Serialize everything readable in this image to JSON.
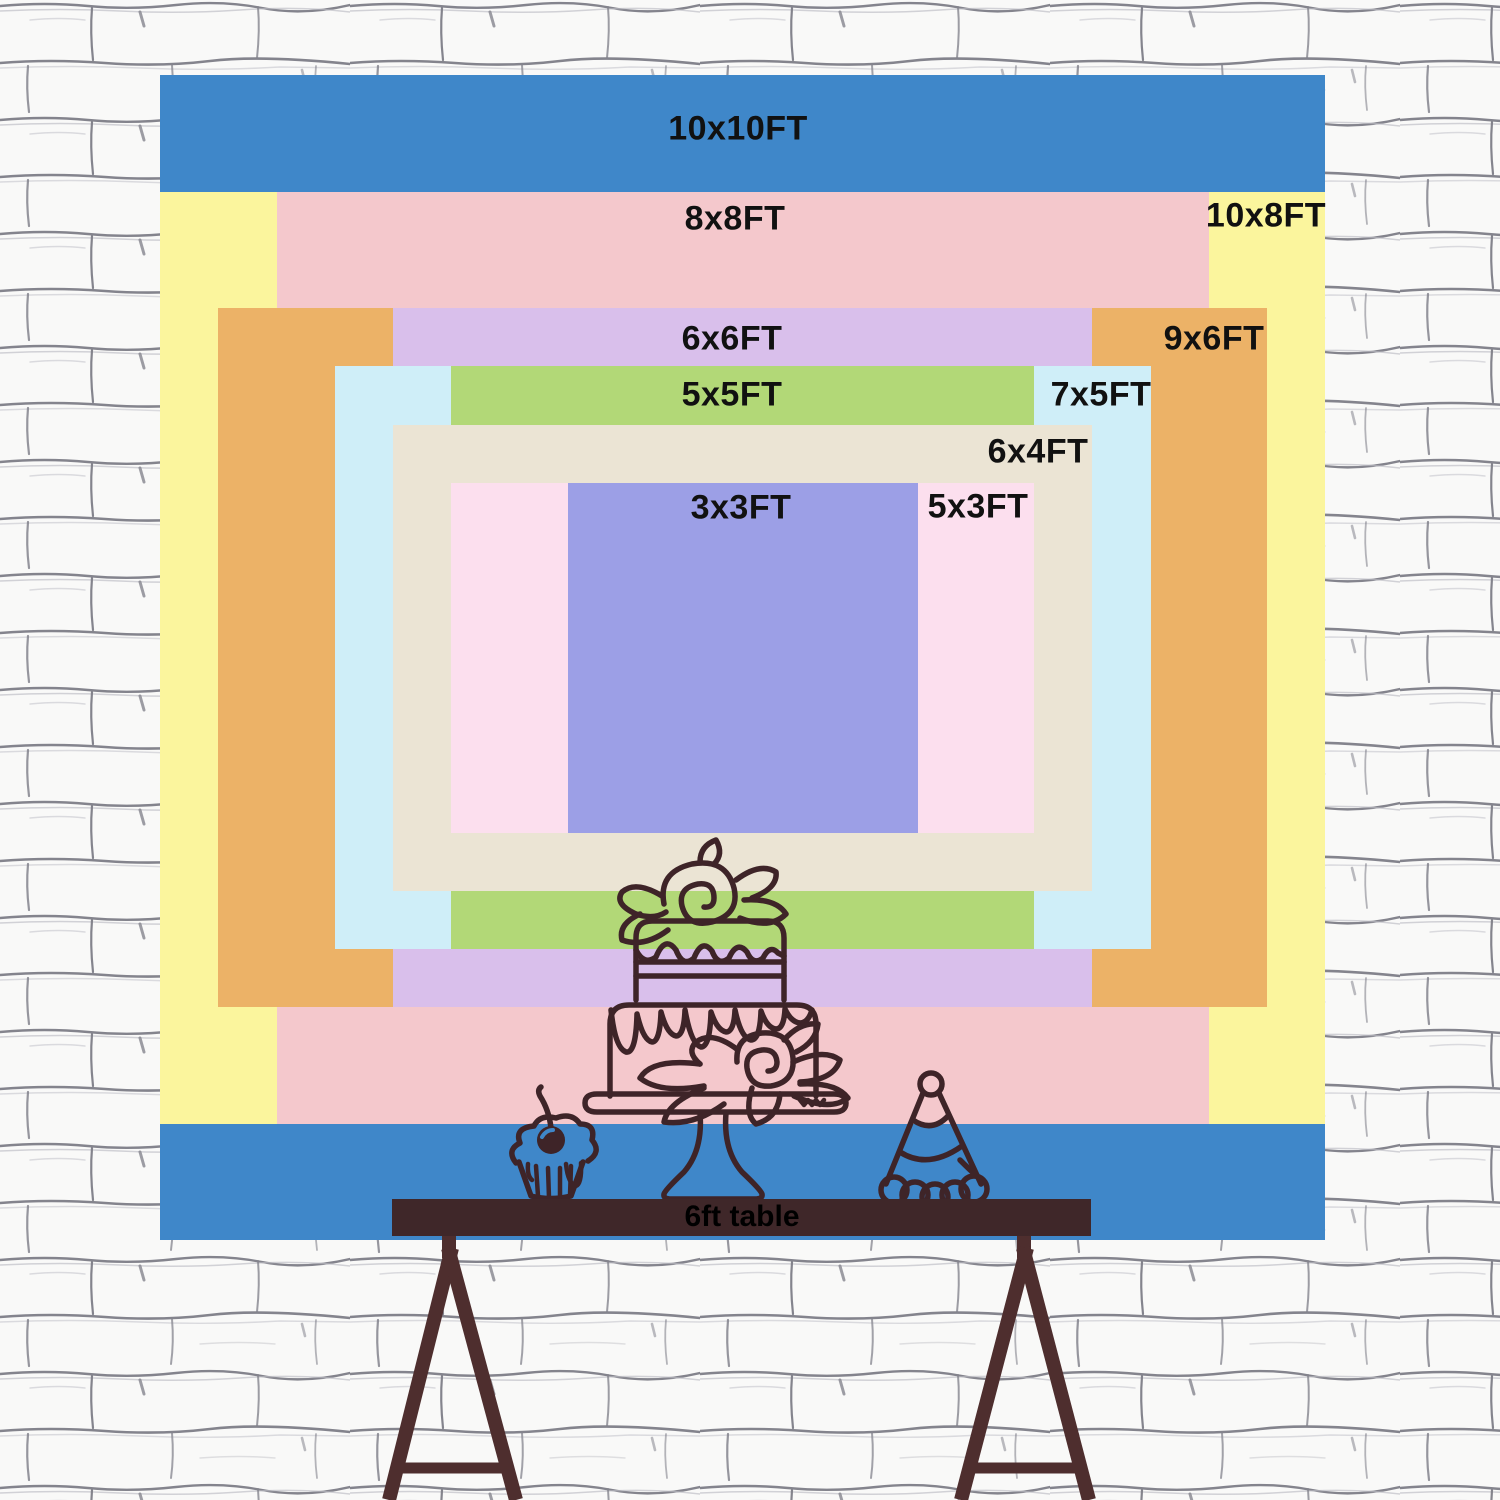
{
  "colors": {
    "size-10x10": "#3f87c9",
    "size-10x8": "#fbf59d",
    "size-8x8": "#f4c8cc",
    "size-9x6": "#ecb267",
    "size-6x6": "#d9bfeb",
    "size-7x5": "#cfeef8",
    "size-5x5": "#b2d877",
    "size-6x4": "#ebe4d4",
    "size-5x3": "#fcdfee",
    "size-3x3": "#9c9fe6",
    "label-text": "#111111",
    "line-art": "#3e2428",
    "table-wood": "#3f2729",
    "leg-wood": "#4e2e2e",
    "wall-bg": "#f9f9f8",
    "wall-line": "#84848d",
    "wall-line-light": "#bcbcc4"
  },
  "backdrop": {
    "sizes": [
      {
        "id": "10x10",
        "label": "10x10FT"
      },
      {
        "id": "10x8",
        "label": "10x8FT"
      },
      {
        "id": "8x8",
        "label": "8x8FT"
      },
      {
        "id": "9x6",
        "label": "9x6FT"
      },
      {
        "id": "6x6",
        "label": "6x6FT"
      },
      {
        "id": "7x5",
        "label": "7x5FT"
      },
      {
        "id": "5x5",
        "label": "5x5FT"
      },
      {
        "id": "6x4",
        "label": "6x4FT"
      },
      {
        "id": "5x3",
        "label": "5x3FT"
      },
      {
        "id": "3x3",
        "label": "3x3FT"
      }
    ]
  },
  "table": {
    "label": "6ft table"
  },
  "icons": {
    "cake": "cake-illustration",
    "cupcake": "cupcake-illustration",
    "party_hat": "party-hat-illustration"
  }
}
